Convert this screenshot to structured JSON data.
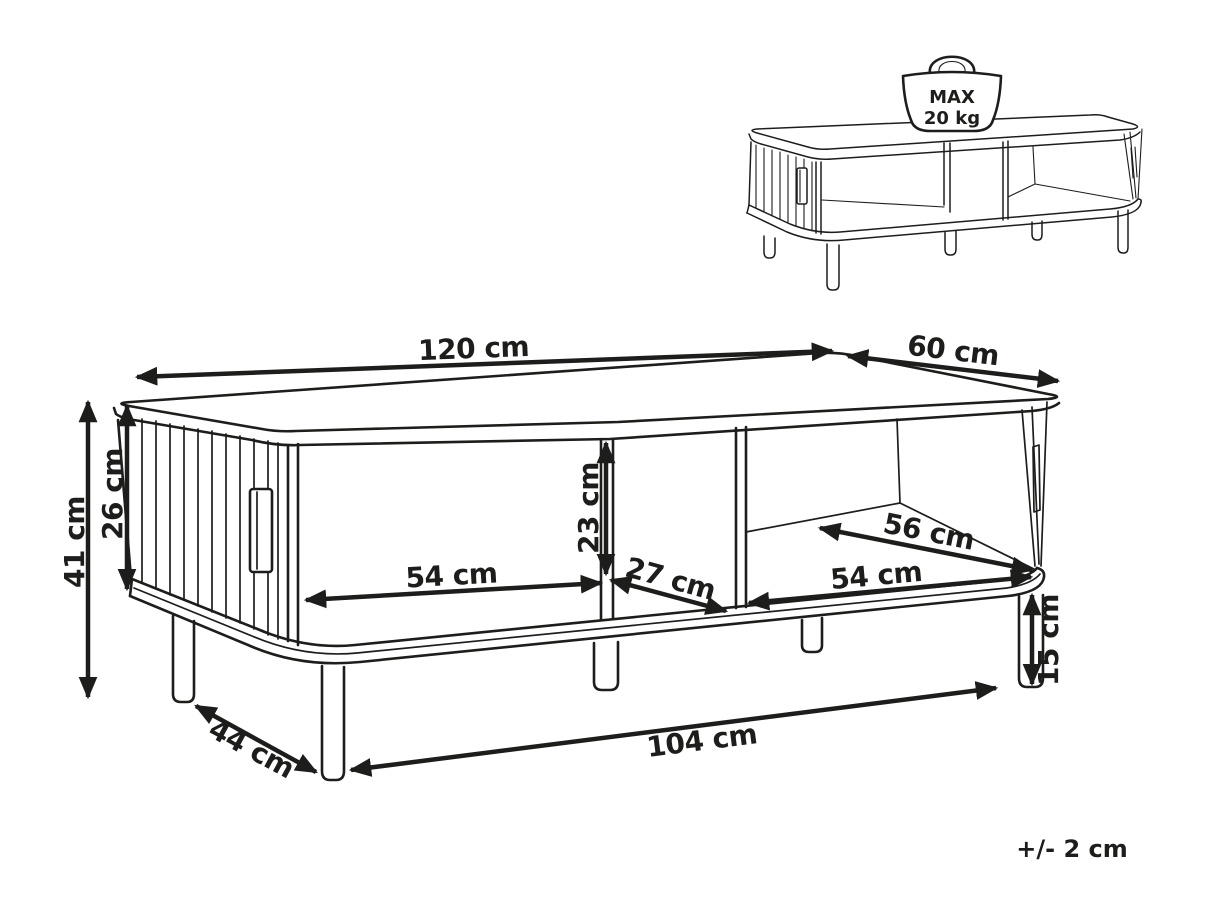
{
  "colors": {
    "ink": "#1d1d1b",
    "background": "#ffffff"
  },
  "dimensions": {
    "length": "120 cm",
    "depth": "60 cm",
    "height": "41 cm",
    "body_height": "26 cm",
    "opening_height": "23 cm",
    "left_opening_width": "54 cm",
    "center_gap_width": "27 cm",
    "shelf_depth": "56 cm",
    "right_opening_width": "54 cm",
    "shelf_clearance_height": "15 cm",
    "leg_span_length": "104 cm",
    "leg_span_depth": "44 cm"
  },
  "max_load": {
    "label": "MAX",
    "value": "20 kg"
  },
  "tolerance_note": "+/- 2 cm"
}
